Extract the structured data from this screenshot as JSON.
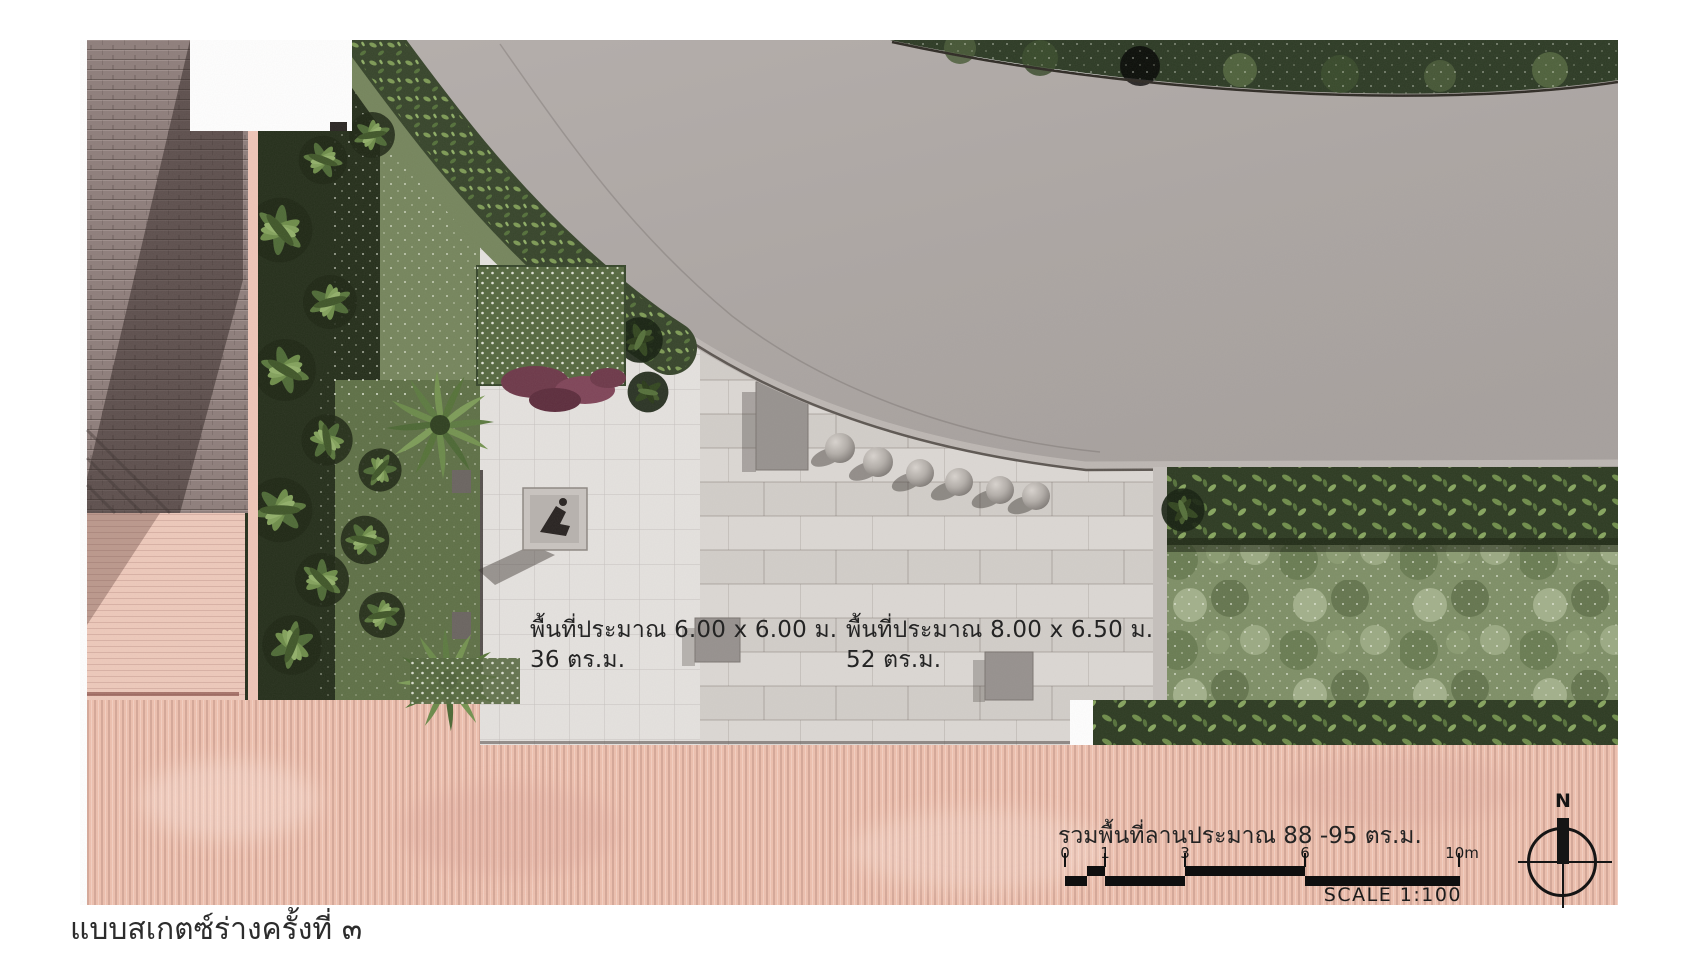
{
  "document": {
    "caption": "แบบสเกตซ์ร่างครั้งที่ ๓"
  },
  "plan": {
    "area_labels": [
      {
        "line1": "พื้นที่ประมาณ 6.00 x 6.00 ม.",
        "line2": "36 ตร.ม."
      },
      {
        "line1": "พื้นที่ประมาณ 8.00 x 6.50 ม.",
        "line2": "52 ตร.ม."
      }
    ],
    "total_area_label": "รวมพื้นที่ลานประมาณ 88 -95 ตร.ม.",
    "scale_bar": {
      "tick_labels": [
        "0",
        "1",
        "3",
        "6",
        "10m"
      ],
      "scale_label": "SCALE 1:100"
    },
    "compass": {
      "label": "N"
    },
    "colors": {
      "paving_pink": "#eec0ae",
      "road_gray": "#aba4a2",
      "plaza_light": "#e5e2df",
      "lawn_green": "#7e8f66",
      "hedge_green": "#2f3d23",
      "text": "#242424"
    }
  }
}
